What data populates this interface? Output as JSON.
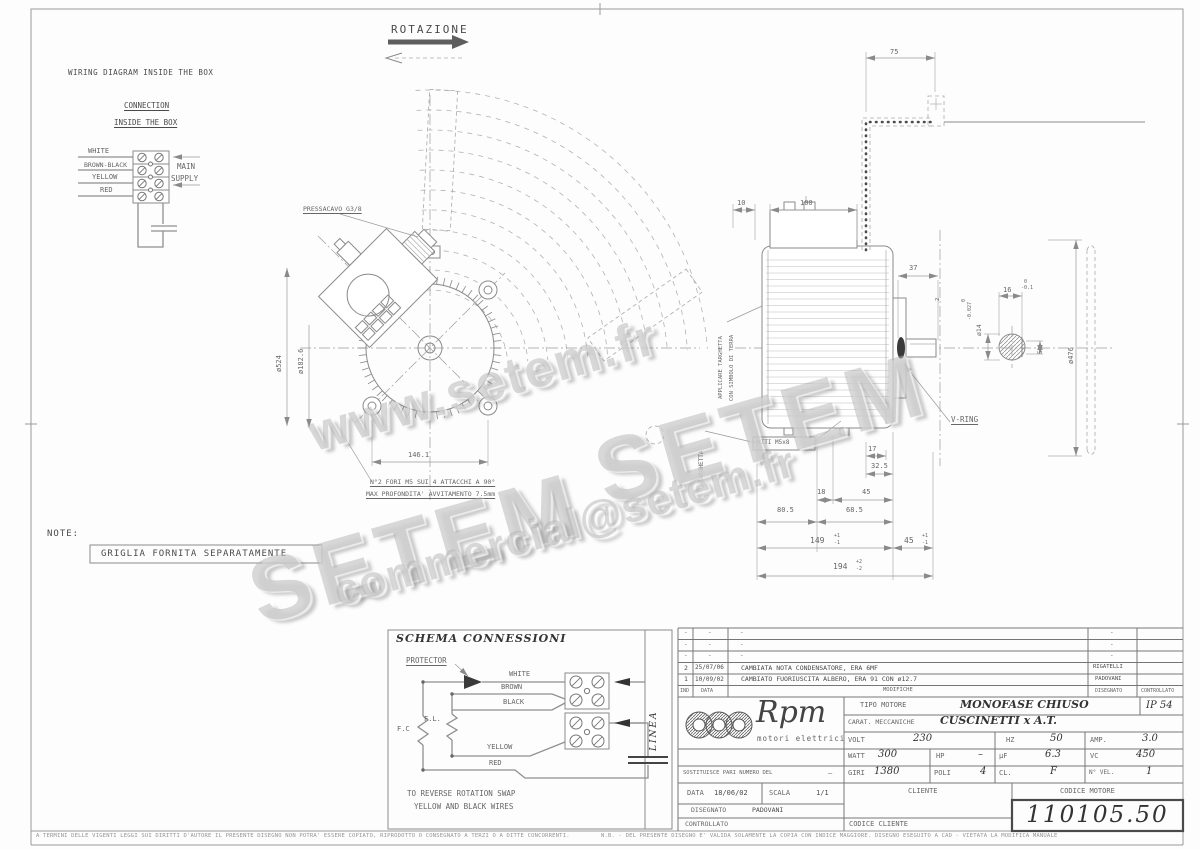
{
  "watermarks": {
    "www": "www.setem.fr",
    "setem_a": "SETEM",
    "setem_b": "SETEM",
    "email": "commercial@setem.fr"
  },
  "rotation": {
    "label": "ROTAZIONE"
  },
  "wiring_box": {
    "title": "WIRING DIAGRAM INSIDE THE BOX",
    "subtitle_1": "CONNECTION",
    "subtitle_2": "INSIDE THE BOX",
    "wire_1": "WHITE",
    "wire_2": "BROWN-BLACK",
    "wire_3": "YELLOW",
    "wire_4": "RED",
    "supply_1": "MAIN",
    "supply_2": "SUPPLY"
  },
  "front_view": {
    "pressacavo": "PRESSACAVO G3/8",
    "dia_outer": "ø524",
    "dia_bolt": "ø182.6",
    "dim_width": "146.1",
    "note_1": "N°2 FORI M5 SUI 4 ATTACCHI A 90°",
    "note_2": "MAX PROFONDITA' AVVITAMENTO 7.5mm"
  },
  "side_view": {
    "dim_75": "75",
    "dim_10": "10",
    "dim_100": "100",
    "dim_37": "37",
    "dim_2": "2",
    "dia_shaft": "ø14",
    "tol_shaft_top": "0",
    "tol_shaft_bot": "-0.027",
    "dim_16": "16",
    "tol_16_top": "0",
    "tol_16_bot": "-0.1",
    "dim_5": "5",
    "dia_fan": "ø476",
    "dim_17": "17",
    "dim_32_5": "32.5",
    "dim_18": "18",
    "dim_45a": "45",
    "dim_80_5": "80.5",
    "dim_68_5": "68.5",
    "dim_149": "149",
    "tol_149_top": "+1",
    "tol_149_bot": "-1",
    "dim_45b": "45",
    "tol_45b_top": "+1",
    "tol_45b_bot": "-1",
    "dim_194": "194",
    "tol_194_top": "+2",
    "tol_194_bot": "-2",
    "label_vring": "V-RING",
    "label_viti": "VITI M5x8",
    "label_targhetta_1": "APPLICARE TARGHETTA",
    "label_targhetta_2": "CON SIMBOLO DI TERRA",
    "label_targhetta_3": "TARGHETTA"
  },
  "note": {
    "label": "NOTE:",
    "text": "GRIGLIA FORNITA SEPARATAMENTE"
  },
  "schema": {
    "title": "SCHEMA CONNESSIONI",
    "protector": "PROTECTOR",
    "wire_white": "WHITE",
    "wire_brown": "BROWN",
    "wire_black": "BLACK",
    "wire_yellow": "YELLOW",
    "wire_red": "RED",
    "fc": "F.C",
    "fl": "F.L.",
    "linea": "LINEA",
    "note_1": "TO REVERSE ROTATION SWAP",
    "note_2": "YELLOW AND BLACK WIRES"
  },
  "title_block": {
    "revisions": [
      {
        "ind": "-",
        "date": "-",
        "desc": "-",
        "by": "-"
      },
      {
        "ind": "-",
        "date": "-",
        "desc": "-",
        "by": "-"
      },
      {
        "ind": "-",
        "date": "-",
        "desc": "-",
        "by": "-"
      },
      {
        "ind": "2",
        "date": "25/07/06",
        "desc": "CAMBIATA NOTA CONDENSATORE, ERA 6MF",
        "by": "RIGATELLI"
      },
      {
        "ind": "1",
        "date": "10/09/02",
        "desc": "CAMBIATO FUORIUSCITA ALBERO, ERA 91 CON ø12.7",
        "by": "PADOVANI"
      }
    ],
    "col_ind": "IND",
    "col_data": "DATA",
    "col_modifiche": "MODIFICHE",
    "col_disegnato": "DISEGNATO",
    "col_controllato": "CONTROLLATO",
    "logo_name": "Rpm",
    "logo_sub": "motori elettrici",
    "tipo_label": "TIPO MOTORE",
    "tipo_value": "MONOFASE CHIUSO",
    "ip_value": "IP 54",
    "carat_label": "CARAT. MECCANICHE",
    "carat_value": "CUSCINETTI x A.T.",
    "volt_label": "VOLT",
    "volt_value": "230",
    "hz_label": "HZ",
    "hz_value": "50",
    "amp_label": "AMP.",
    "amp_value": "3.0",
    "watt_label": "WATT",
    "watt_value": "300",
    "hp_label": "HP",
    "hp_value": "–",
    "uf_label": "µF",
    "uf_value": "6.3",
    "vc_label": "VC",
    "vc_value": "450",
    "giri_label": "GIRI",
    "giri_value": "1380",
    "poli_label": "POLI",
    "poli_value": "4",
    "cl_label": "CL.",
    "cl_value": "F",
    "nvel_label": "N° VEL.",
    "nvel_value": "1",
    "sostituisce_label": "SOSTITUISCE PARI NUMERO DEL",
    "sostituisce_value": "–",
    "data_label": "DATA",
    "data_value": "18/06/02",
    "scala_label": "SCALA",
    "scala_value": "1/1",
    "disegnato_label": "DISEGNATO",
    "disegnato_value": "PADOVANI",
    "controllato_label": "CONTROLLATO",
    "cliente_label": "CLIENTE",
    "codice_cliente_label": "CODICE CLIENTE",
    "codice_motore_label": "CODICE MOTORE",
    "codice_motore_value": "110105.50"
  },
  "footer": {
    "left": "A TERMINI DELLE VIGENTI LEGGI SUI DIRITTI D'AUTORE IL PRESENTE DISEGNO NON POTRA' ESSERE COPIATO, RIPRODOTTO O CONSEGNATO A TERZI O A DITTE CONCORRENTI.",
    "right": "N.B. - DEL PRESENTE DISEGNO E' VALIDA SOLAMENTE LA COPIA CON INDICE MAGGIORE.      DISEGNO ESEGUITO A CAD - VIETATA LA MODIFICA MANUALE"
  }
}
